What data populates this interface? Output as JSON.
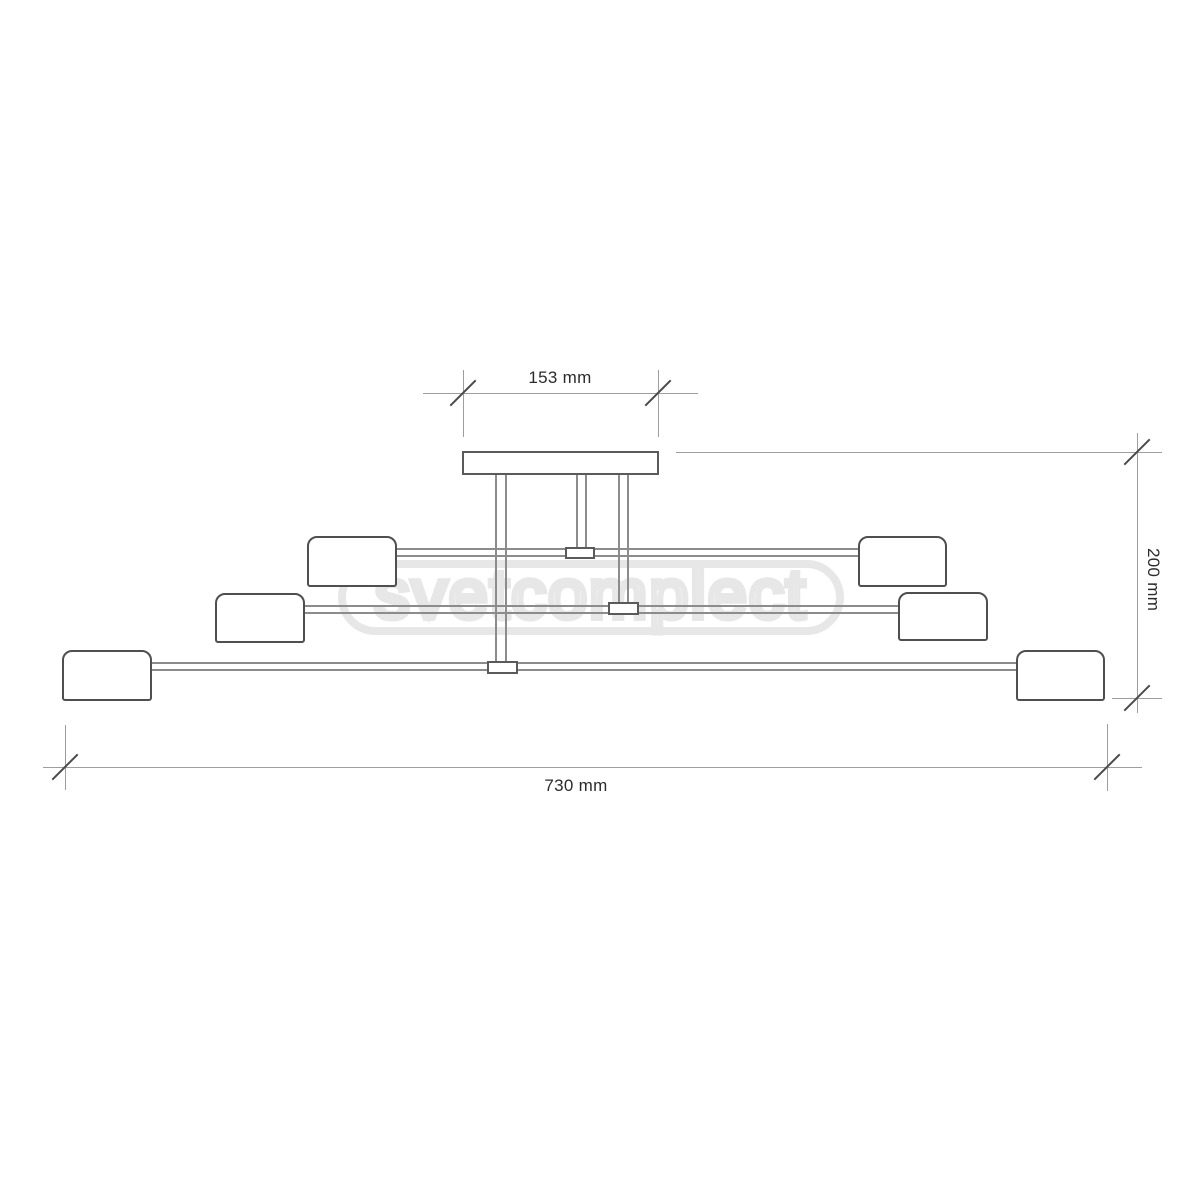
{
  "drawing": {
    "kind": "ceiling-light dimension drawing",
    "lamp_head_count": 6
  },
  "dimensions": {
    "canopy_width": {
      "label": "153 mm"
    },
    "height": {
      "label": "200 mm"
    },
    "total_width": {
      "label": "730 mm"
    }
  },
  "watermark": {
    "text": "svetcomplect"
  },
  "colors": {
    "line": "#8c8c8c",
    "outline": "#4f4f4f",
    "box": "#5a5a5a",
    "dim": "#9e9e9e",
    "slash": "#4a4a4a",
    "text": "#2b2b2b",
    "wm": "#e7e7e7",
    "bg": "#ffffff"
  }
}
